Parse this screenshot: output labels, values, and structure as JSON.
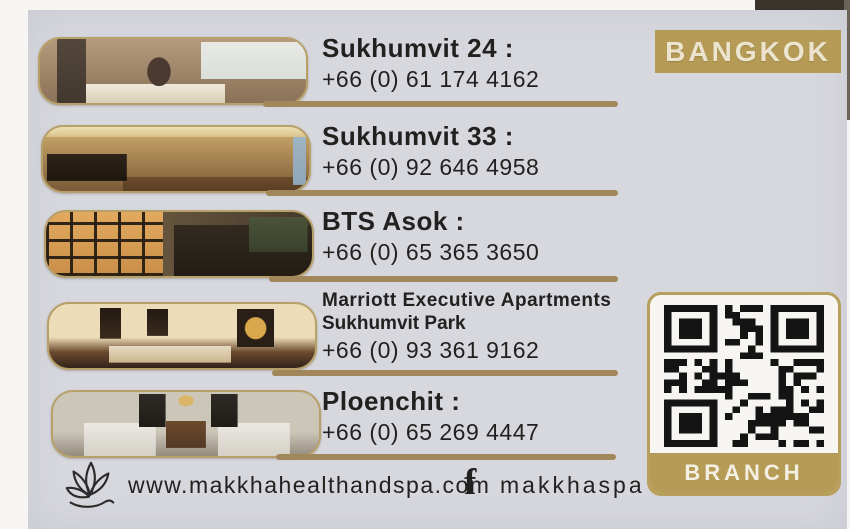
{
  "card": {
    "city_badge": "BANGKOK",
    "branch_badge": "BRANCH",
    "locations": [
      {
        "name": "Sukhumvit 24 :",
        "name2": "",
        "phone": "+66 (0) 61 174 4162",
        "photo_alt": "massage room with therapist"
      },
      {
        "name": "Sukhumvit 33 :",
        "name2": "",
        "phone": "+66 (0) 92 646 4958",
        "photo_alt": "spa lounge interior"
      },
      {
        "name": "BTS Asok :",
        "name2": "",
        "phone": "+66 (0) 65 365 3650",
        "photo_alt": "spa shelves and treatment area"
      },
      {
        "name": "Marriott Executive Apartments",
        "name2": "Sukhumvit Park",
        "phone": "+66 (0) 93 361 9162",
        "photo_alt": "treatment room with massage beds"
      },
      {
        "name": "Ploenchit :",
        "name2": "",
        "phone": "+66 (0) 65 269 4447",
        "photo_alt": "twin massage beds room"
      }
    ],
    "footer": {
      "website": "www.makkhahealthandspa.com",
      "facebook_icon_glyph": "f",
      "facebook_handle": "makkhaspa",
      "logo_icon": "lotus-icon"
    },
    "colors": {
      "gold_line": "#a2875a",
      "badge_gold": "#b59b55",
      "card_background": "#d7d8de",
      "text": "#23211f"
    }
  }
}
